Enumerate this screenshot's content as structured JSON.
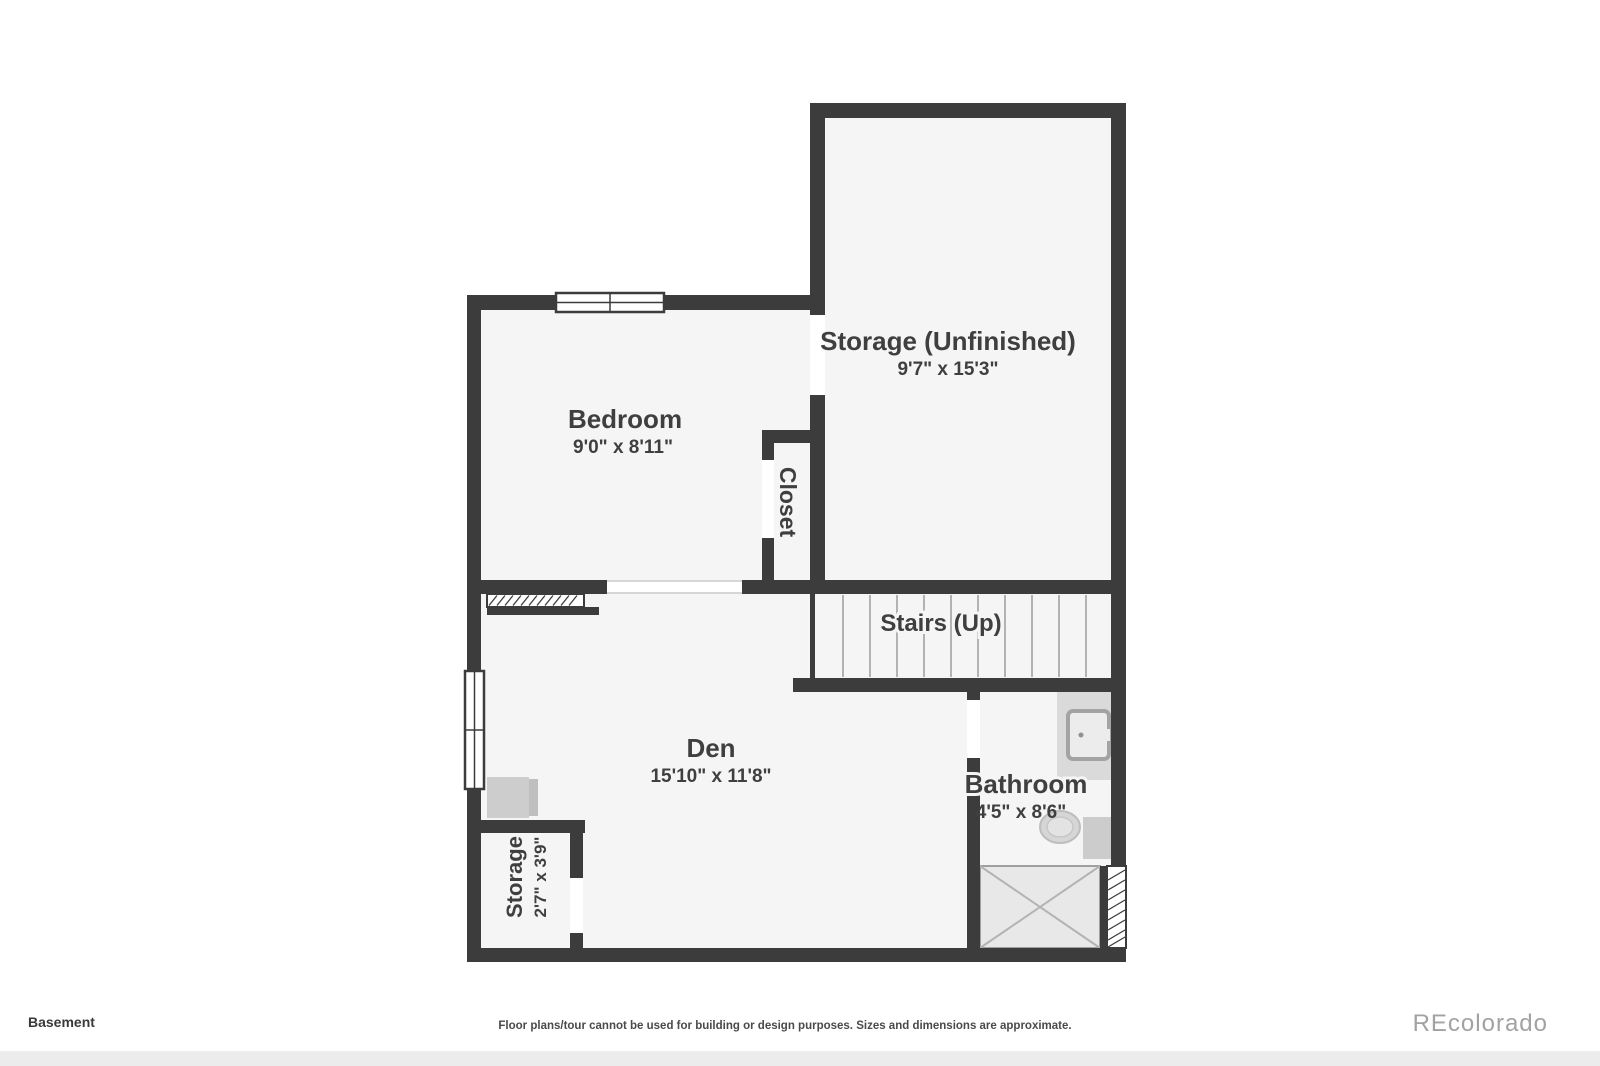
{
  "footer": {
    "floor_label": "Basement",
    "disclaimer": "Floor plans/tour cannot be used for building or design purposes. Sizes and dimensions are approximate.",
    "watermark": "REcolorado"
  },
  "rooms": {
    "storage_unfinished": {
      "name": "Storage (Unfinished)",
      "dims": "9'7\" x 15'3\""
    },
    "bedroom": {
      "name": "Bedroom",
      "dims": "9'0\" x 8'11\""
    },
    "closet": {
      "name": "Closet"
    },
    "stairs": {
      "name": "Stairs (Up)"
    },
    "den": {
      "name": "Den",
      "dims": "15'10\" x 11'8\""
    },
    "bathroom": {
      "name": "Bathroom",
      "dims": "4'5\" x 8'6\""
    },
    "storage_small": {
      "name": "Storage",
      "dims": "2'7\" x 3'9\""
    }
  },
  "fixtures": {
    "sink": "sink",
    "toilet": "toilet",
    "shower": "shower",
    "chair": "chair"
  },
  "colors": {
    "wall": "#3c3c3c",
    "room_fill": "#f5f5f5",
    "label": "#3f3f3f",
    "fixture_gray": "#d6d6d6",
    "tread_line": "#9b9b9b",
    "watermark_gray": "#a2a2a2"
  }
}
